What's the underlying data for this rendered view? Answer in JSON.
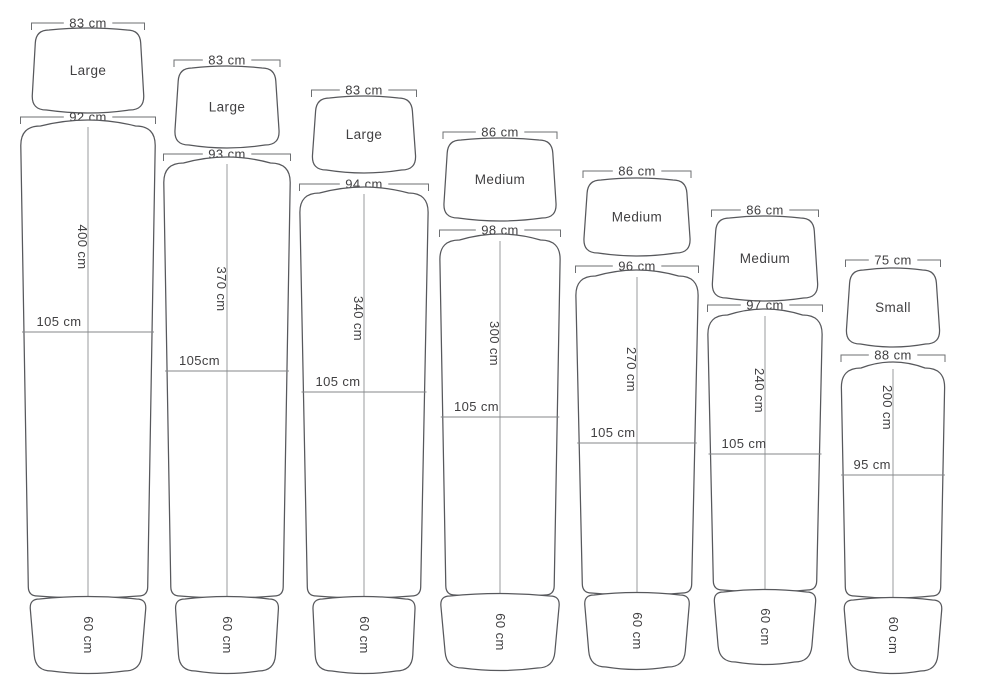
{
  "diagram": {
    "name": "board-size-chart",
    "unit": "cm",
    "boards": [
      {
        "size_label": "Large",
        "nose_width": "83 cm",
        "deck_width": "92 cm",
        "length": "400 cm",
        "mid_width": "105 cm",
        "tail_width": "60 cm"
      },
      {
        "size_label": "Large",
        "nose_width": "83 cm",
        "deck_width": "93 cm",
        "length": "370 cm",
        "mid_width": "105cm",
        "tail_width": "60 cm"
      },
      {
        "size_label": "Large",
        "nose_width": "83 cm",
        "deck_width": "94 cm",
        "length": "340 cm",
        "mid_width": "105 cm",
        "tail_width": "60 cm"
      },
      {
        "size_label": "Medium",
        "nose_width": "86 cm",
        "deck_width": "98 cm",
        "length": "300 cm",
        "mid_width": "105 cm",
        "tail_width": "60 cm"
      },
      {
        "size_label": "Medium",
        "nose_width": "86 cm",
        "deck_width": "96 cm",
        "length": "270 cm",
        "mid_width": "105 cm",
        "tail_width": "60 cm"
      },
      {
        "size_label": "Medium",
        "nose_width": "86 cm",
        "deck_width": "97 cm",
        "length": "240 cm",
        "mid_width": "105 cm",
        "tail_width": "60 cm"
      },
      {
        "size_label": "Small",
        "nose_width": "75 cm",
        "deck_width": "88 cm",
        "length": "200 cm",
        "mid_width": "95 cm",
        "tail_width": "60 cm"
      }
    ],
    "colors": {
      "outline": "#57585c",
      "inner_line": "#999b9e",
      "text": "#414042"
    }
  }
}
